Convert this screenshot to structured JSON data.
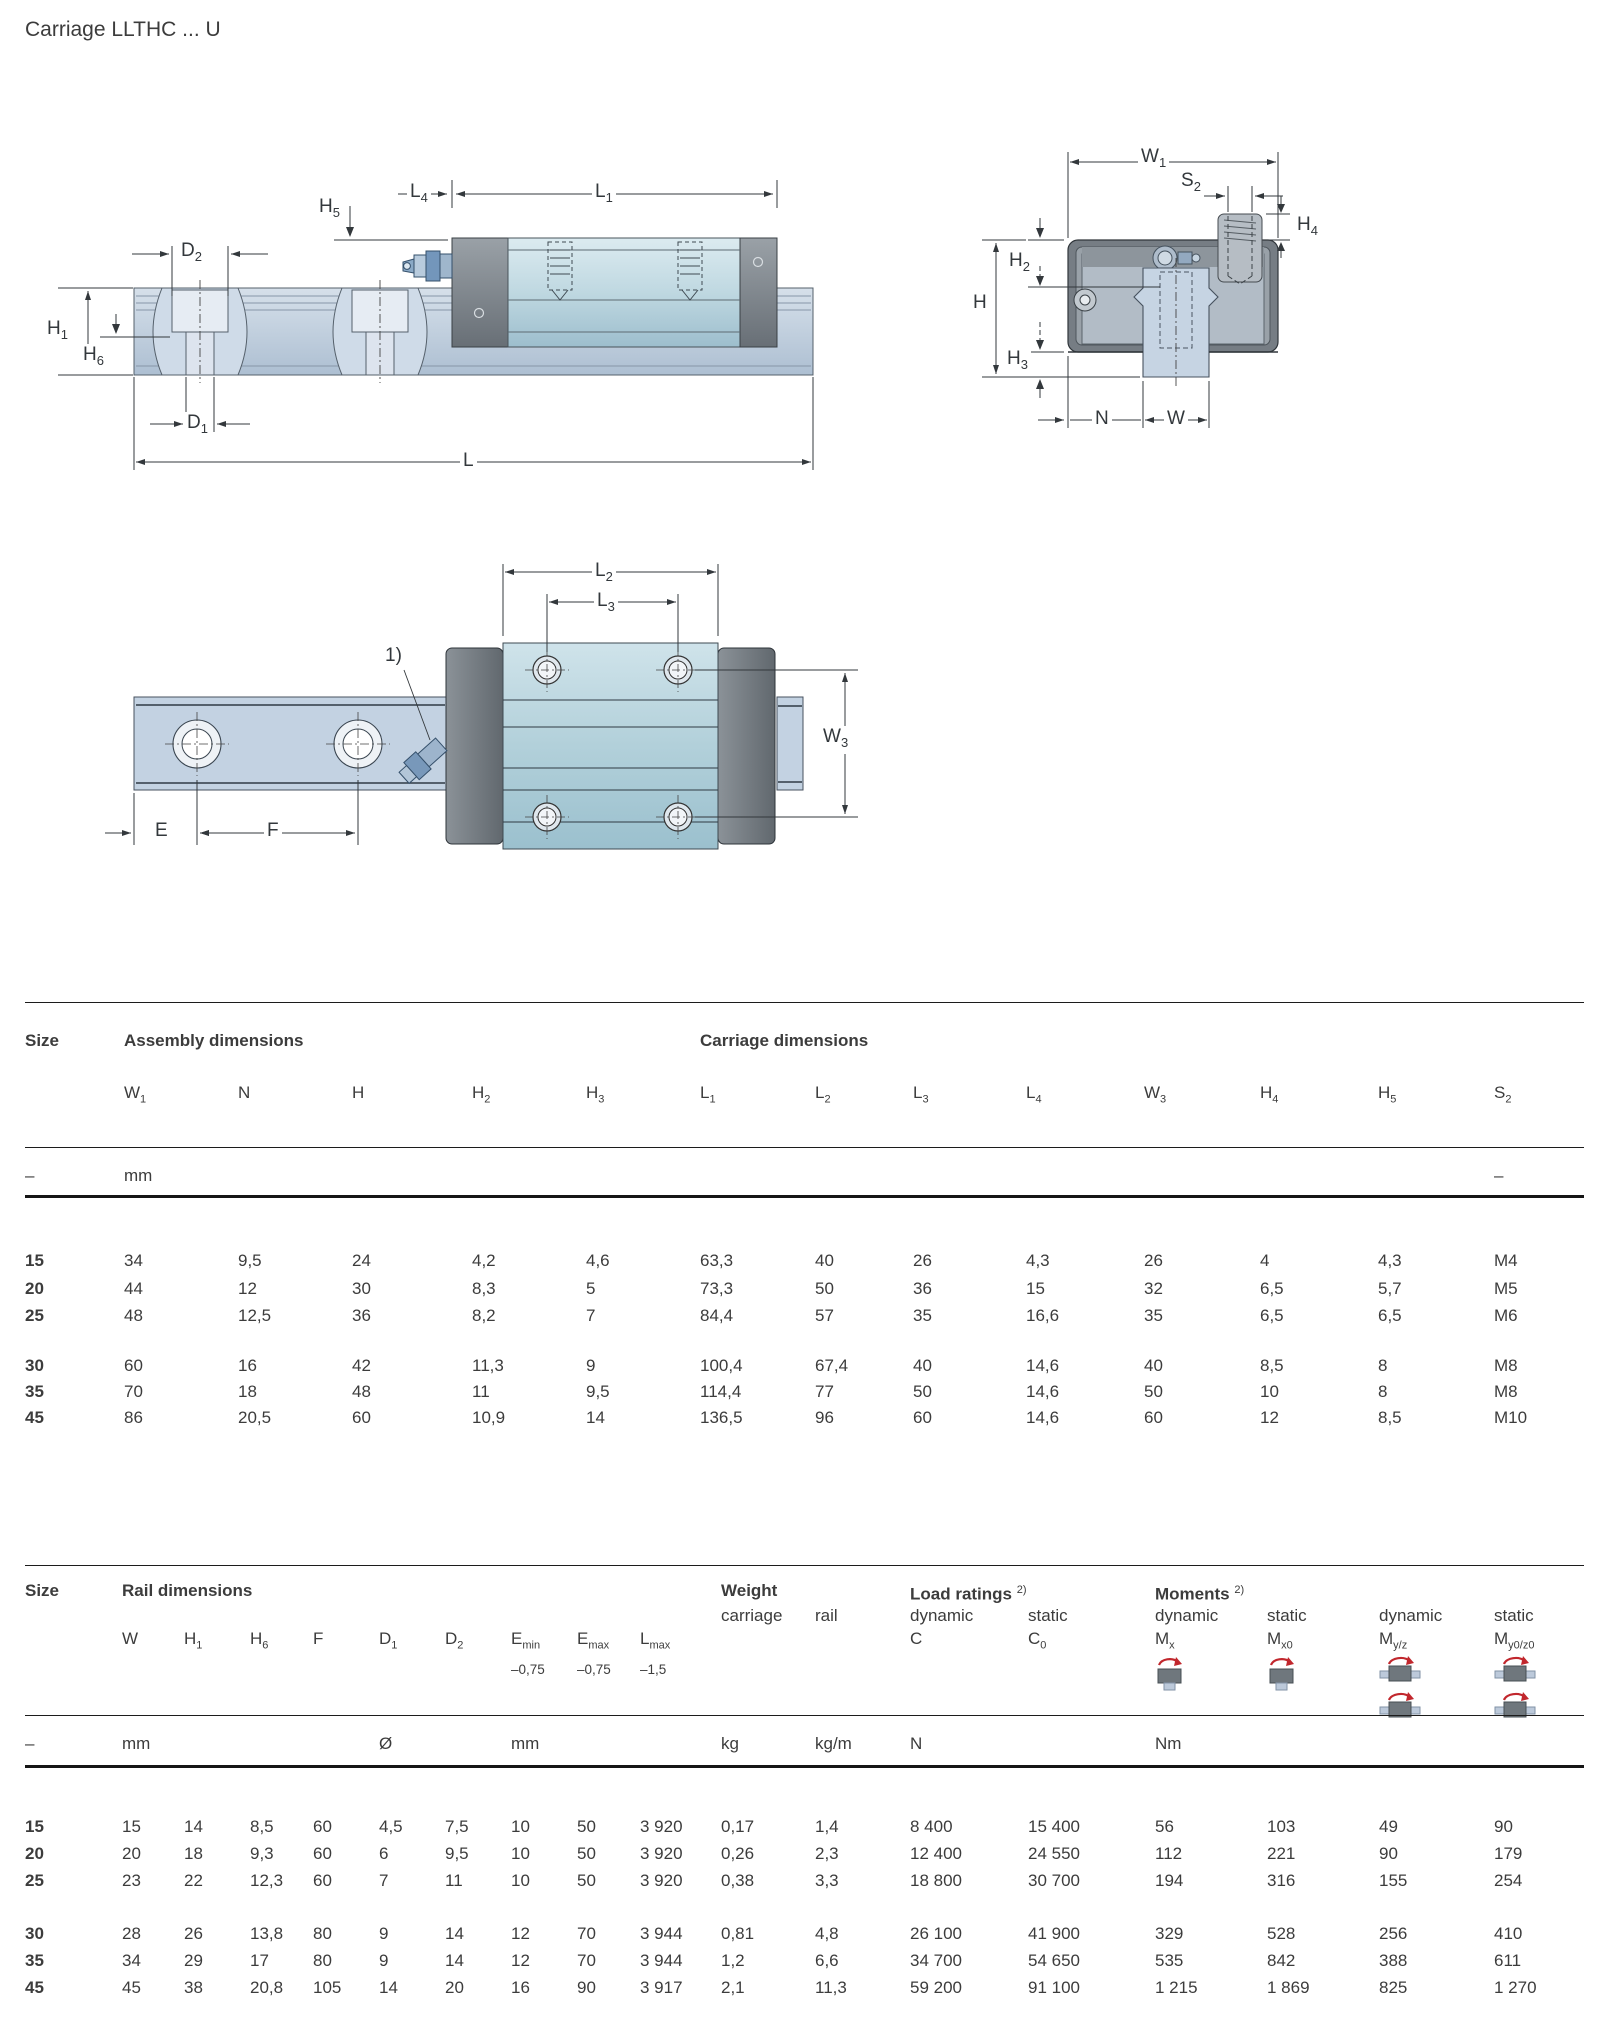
{
  "page": {
    "title": "Carriage LLTHC ... U"
  },
  "colors": {
    "accent_red": "#c1272d",
    "rail_blue": "#c3d2e2",
    "body_teal": "#bcd6de",
    "cap_gray": "#6f777d",
    "text": "#3c3c3c"
  },
  "drawings": {
    "note1": "1)",
    "side": {
      "h5": {
        "b": "H",
        "s": "5"
      },
      "l4": {
        "b": "L",
        "s": "4"
      },
      "l1": {
        "b": "L",
        "s": "1"
      },
      "d2": {
        "b": "D",
        "s": "2"
      },
      "h1": {
        "b": "H",
        "s": "1"
      },
      "h6": {
        "b": "H",
        "s": "6"
      },
      "d1": {
        "b": "D",
        "s": "1"
      },
      "l": {
        "b": "L",
        "s": ""
      }
    },
    "end": {
      "w1": {
        "b": "W",
        "s": "1"
      },
      "s2": {
        "b": "S",
        "s": "2"
      },
      "h2": {
        "b": "H",
        "s": "2"
      },
      "h": {
        "b": "H",
        "s": ""
      },
      "h3": {
        "b": "H",
        "s": "3"
      },
      "h4": {
        "b": "H",
        "s": "4"
      },
      "n": {
        "b": "N",
        "s": ""
      },
      "w": {
        "b": "W",
        "s": ""
      }
    },
    "top": {
      "l2": {
        "b": "L",
        "s": "2"
      },
      "l3": {
        "b": "L",
        "s": "3"
      },
      "w3": {
        "b": "W",
        "s": "3"
      },
      "e": {
        "b": "E",
        "s": ""
      },
      "f": {
        "b": "F",
        "s": ""
      }
    }
  },
  "table1": {
    "size_header": "Size",
    "group1": "Assembly dimensions",
    "group2": "Carriage dimensions",
    "columns": [
      {
        "b": "W",
        "s": "1"
      },
      {
        "b": "N",
        "s": ""
      },
      {
        "b": "H",
        "s": ""
      },
      {
        "b": "H",
        "s": "2"
      },
      {
        "b": "H",
        "s": "3"
      },
      {
        "b": "L",
        "s": "1"
      },
      {
        "b": "L",
        "s": "2"
      },
      {
        "b": "L",
        "s": "3"
      },
      {
        "b": "L",
        "s": "4"
      },
      {
        "b": "W",
        "s": "3"
      },
      {
        "b": "H",
        "s": "4"
      },
      {
        "b": "H",
        "s": "5"
      },
      {
        "b": "S",
        "s": "2"
      }
    ],
    "units": {
      "size": "–",
      "mm": "mm",
      "right": "–"
    },
    "groups": [
      [
        [
          "15",
          "34",
          "9,5",
          "24",
          "4,2",
          "4,6",
          "63,3",
          "40",
          "26",
          "4,3",
          "26",
          "4",
          "4,3",
          "M4"
        ],
        [
          "20",
          "44",
          "12",
          "30",
          "8,3",
          "5",
          "73,3",
          "50",
          "36",
          "15",
          "32",
          "6,5",
          "5,7",
          "M5"
        ],
        [
          "25",
          "48",
          "12,5",
          "36",
          "8,2",
          "7",
          "84,4",
          "57",
          "35",
          "16,6",
          "35",
          "6,5",
          "6,5",
          "M6"
        ]
      ],
      [
        [
          "30",
          "60",
          "16",
          "42",
          "11,3",
          "9",
          "100,4",
          "67,4",
          "40",
          "14,6",
          "40",
          "8,5",
          "8",
          "M8"
        ],
        [
          "35",
          "70",
          "18",
          "48",
          "11",
          "9,5",
          "114,4",
          "77",
          "50",
          "14,6",
          "50",
          "10",
          "8",
          "M8"
        ],
        [
          "45",
          "86",
          "20,5",
          "60",
          "10,9",
          "14",
          "136,5",
          "96",
          "60",
          "14,6",
          "60",
          "12",
          "8,5",
          "M10"
        ]
      ]
    ]
  },
  "table2": {
    "size_header": "Size",
    "group1": "Rail dimensions",
    "group2": "Weight",
    "group3": "Load ratings",
    "group3_sup": "2)",
    "group4": "Moments",
    "group4_sup": "2)",
    "sub": {
      "carriage": "carriage",
      "rail": "rail",
      "dynamic": "dynamic",
      "static": "static"
    },
    "columns": [
      {
        "b": "W",
        "s": ""
      },
      {
        "b": "H",
        "s": "1"
      },
      {
        "b": "H",
        "s": "6"
      },
      {
        "b": "F",
        "s": ""
      },
      {
        "b": "D",
        "s": "1"
      },
      {
        "b": "D",
        "s": "2"
      },
      {
        "b": "E",
        "s": "min"
      },
      {
        "b": "E",
        "s": "max"
      },
      {
        "b": "L",
        "s": "max"
      }
    ],
    "load_syms": [
      {
        "b": "C",
        "s": ""
      },
      {
        "b": "C",
        "s": "0"
      }
    ],
    "moment_syms": [
      {
        "b": "M",
        "s": "x"
      },
      {
        "b": "M",
        "s": "x0"
      },
      {
        "b": "M",
        "s": "y/z"
      },
      {
        "b": "M",
        "s": "y0/z0"
      }
    ],
    "tolerances": [
      "–0,75",
      "–0,75",
      "–1,5"
    ],
    "units": {
      "size": "–",
      "mm1": "mm",
      "dia": "Ø",
      "mm2": "mm",
      "kg": "kg",
      "kgm": "kg/m",
      "n": "N",
      "nm": "Nm"
    },
    "groups": [
      [
        [
          "15",
          "15",
          "14",
          "8,5",
          "60",
          "4,5",
          "7,5",
          "10",
          "50",
          "3 920",
          "0,17",
          "1,4",
          "8 400",
          "15 400",
          "56",
          "103",
          "49",
          "90"
        ],
        [
          "20",
          "20",
          "18",
          "9,3",
          "60",
          "6",
          "9,5",
          "10",
          "50",
          "3 920",
          "0,26",
          "2,3",
          "12 400",
          "24 550",
          "112",
          "221",
          "90",
          "179"
        ],
        [
          "25",
          "23",
          "22",
          "12,3",
          "60",
          "7",
          "11",
          "10",
          "50",
          "3 920",
          "0,38",
          "3,3",
          "18 800",
          "30 700",
          "194",
          "316",
          "155",
          "254"
        ]
      ],
      [
        [
          "30",
          "28",
          "26",
          "13,8",
          "80",
          "9",
          "14",
          "12",
          "70",
          "3 944",
          "0,81",
          "4,8",
          "26 100",
          "41 900",
          "329",
          "528",
          "256",
          "410"
        ],
        [
          "35",
          "34",
          "29",
          "17",
          "80",
          "9",
          "14",
          "12",
          "70",
          "3 944",
          "1,2",
          "6,6",
          "34 700",
          "54 650",
          "535",
          "842",
          "388",
          "611"
        ],
        [
          "45",
          "45",
          "38",
          "20,8",
          "105",
          "14",
          "20",
          "16",
          "90",
          "3 917",
          "2,1",
          "11,3",
          "59 200",
          "91 100",
          "1 215",
          "1 869",
          "825",
          "1 270"
        ]
      ]
    ]
  }
}
